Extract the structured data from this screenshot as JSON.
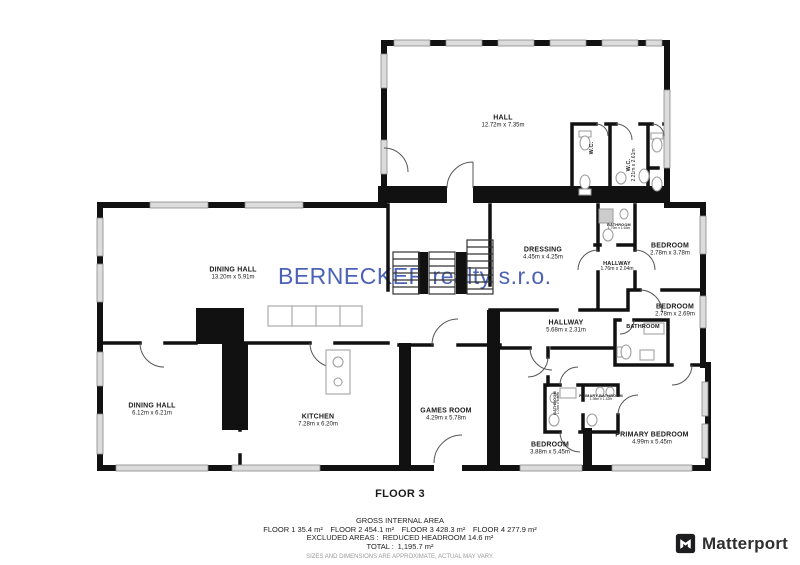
{
  "watermark": {
    "text": "BERNECKER realty s.r.o.",
    "color": "#3c55b0"
  },
  "floor_title": "FLOOR 3",
  "rooms": [
    {
      "name": "HALL",
      "dims": "12.72m x 7.35m"
    },
    {
      "name": "W.C.",
      "dims": ""
    },
    {
      "name": "W.C.",
      "dims": "2.21m x 2.61m"
    },
    {
      "name": "DRESSING",
      "dims": "4.45m x 4.25m"
    },
    {
      "name": "BATHROOM",
      "dims": "1.79m x 1.63m"
    },
    {
      "name": "HALLWAY",
      "dims": "1.76m x 2.04m"
    },
    {
      "name": "BEDROOM",
      "dims": "2.78m x 3.78m"
    },
    {
      "name": "BEDROOM",
      "dims": "2.78m x 2.69m"
    },
    {
      "name": "BATHROOM",
      "dims": ""
    },
    {
      "name": "HALLWAY",
      "dims": "5.68m x 2.31m"
    },
    {
      "name": "DINING HALL",
      "dims": "13.20m x 5.91m"
    },
    {
      "name": "DINING HALL",
      "dims": "6.12m x 6.21m"
    },
    {
      "name": "KITCHEN",
      "dims": "7.28m x 6.20m"
    },
    {
      "name": "GAMES ROOM",
      "dims": "4.29m x 5.78m"
    },
    {
      "name": "BEDROOM",
      "dims": "3.88m x 5.45m"
    },
    {
      "name": "PRIMARY BEDROOM",
      "dims": "4.99m x 5.45m"
    },
    {
      "name": "PRIMARY BATHROOM",
      "dims": "1.98m x 1.42m"
    },
    {
      "name": "BATHROOM",
      "dims": "1.05m x 1.40m"
    }
  ],
  "footer": {
    "title": "GROSS INTERNAL AREA",
    "floors": "FLOOR 1 35.4 m² FLOOR 2 454.1 m² FLOOR 3 428.3 m² FLOOR 4 277.9 m²",
    "excluded": "EXCLUDED AREAS : REDUCED HEADROOM 14.6 m²",
    "total": "TOTAL : 1,195.7 m²",
    "disclaimer": "SIZES AND DIMENSIONS ARE APPROXIMATE, ACTUAL MAY VARY."
  },
  "branding": {
    "name": "Matterport"
  },
  "colors": {
    "wall": "#111111",
    "window": "#dcdcdc",
    "watermark": "#3c55b0"
  }
}
